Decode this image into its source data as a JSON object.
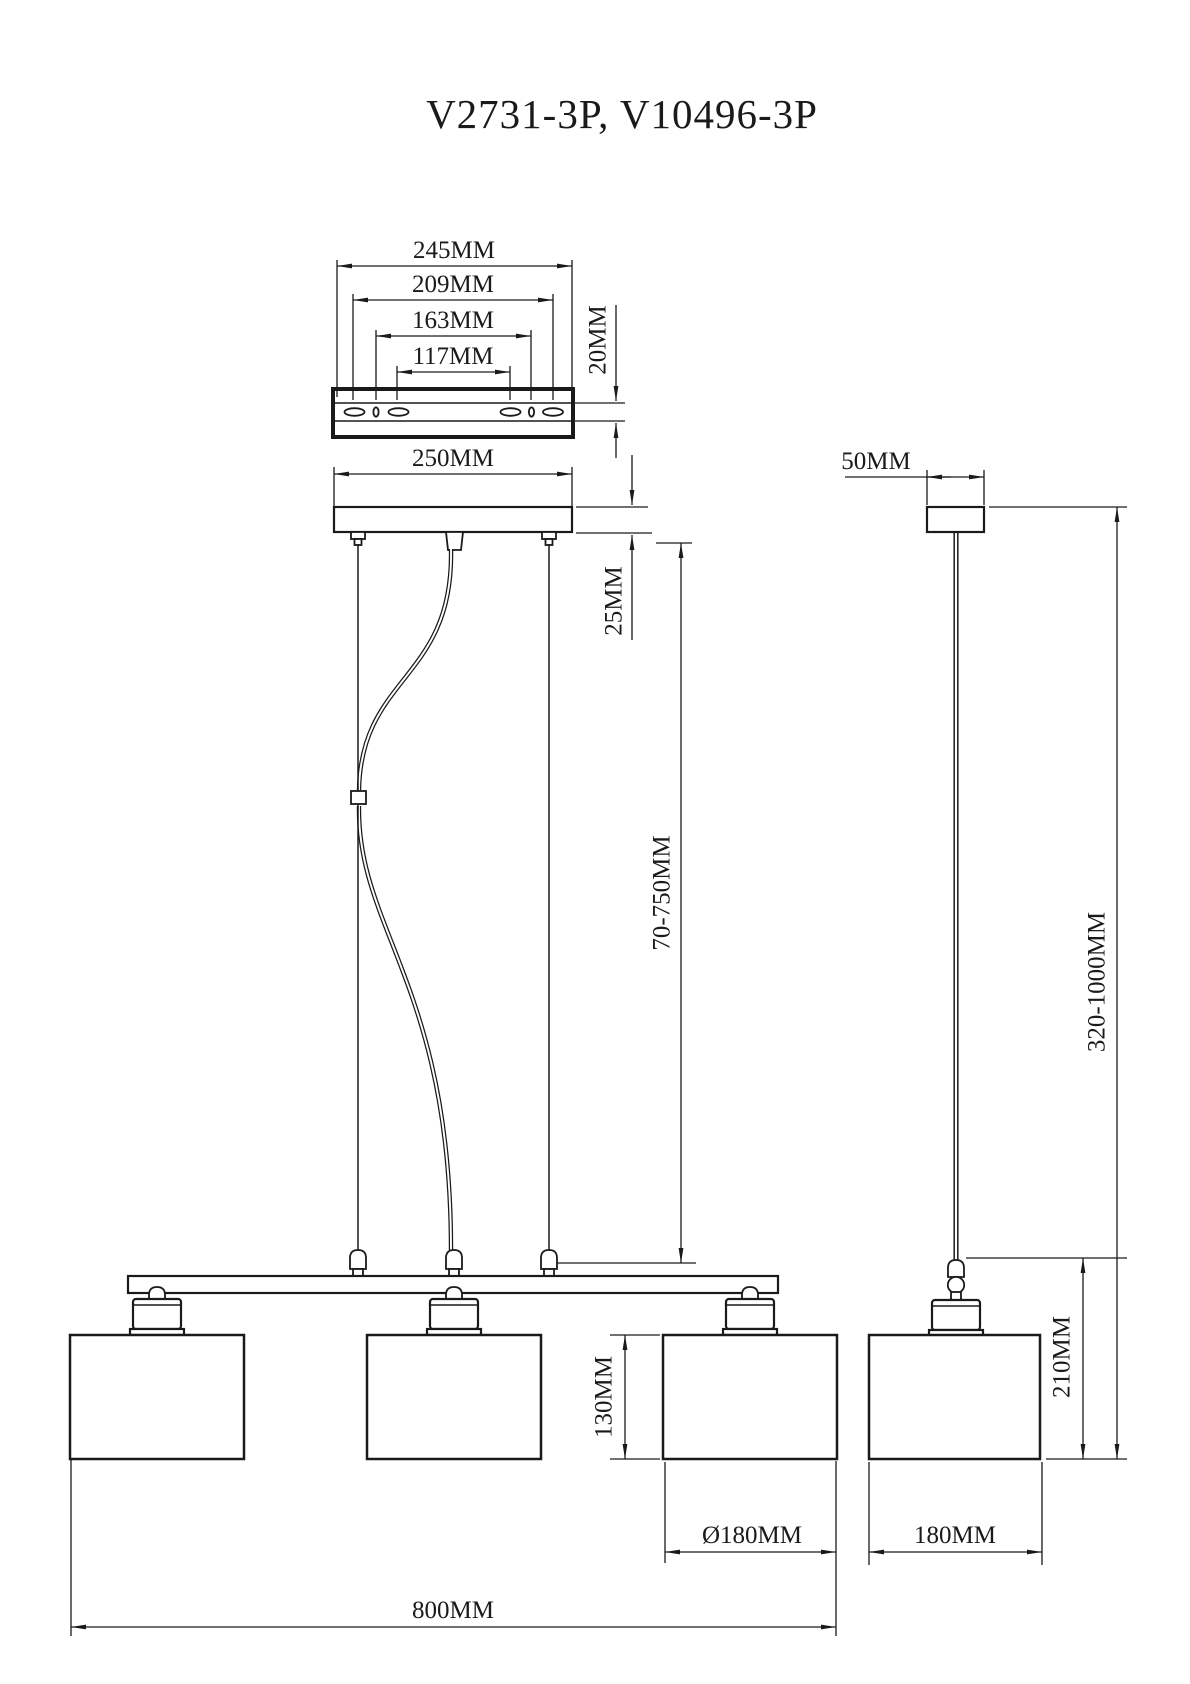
{
  "title": "V2731-3P, V10496-3P",
  "colors": {
    "ink": "#1a1a1a",
    "background": "#ffffff"
  },
  "front_view": {
    "bracket_slot_span_outer": "245MM",
    "bracket_slot_span_2": "209MM",
    "bracket_slot_span_3": "163MM",
    "bracket_slot_span_inner": "117MM",
    "bracket_thickness": "20MM",
    "canopy_width": "250MM",
    "canopy_height": "25MM",
    "suspension_length": "70-750MM",
    "shade_height": "130MM",
    "shade_diameter": "Ø180MM",
    "overall_width": "800MM"
  },
  "side_view": {
    "canopy_depth": "50MM",
    "overall_height": "320-1000MM",
    "pendant_height": "210MM",
    "shade_depth": "180MM"
  }
}
